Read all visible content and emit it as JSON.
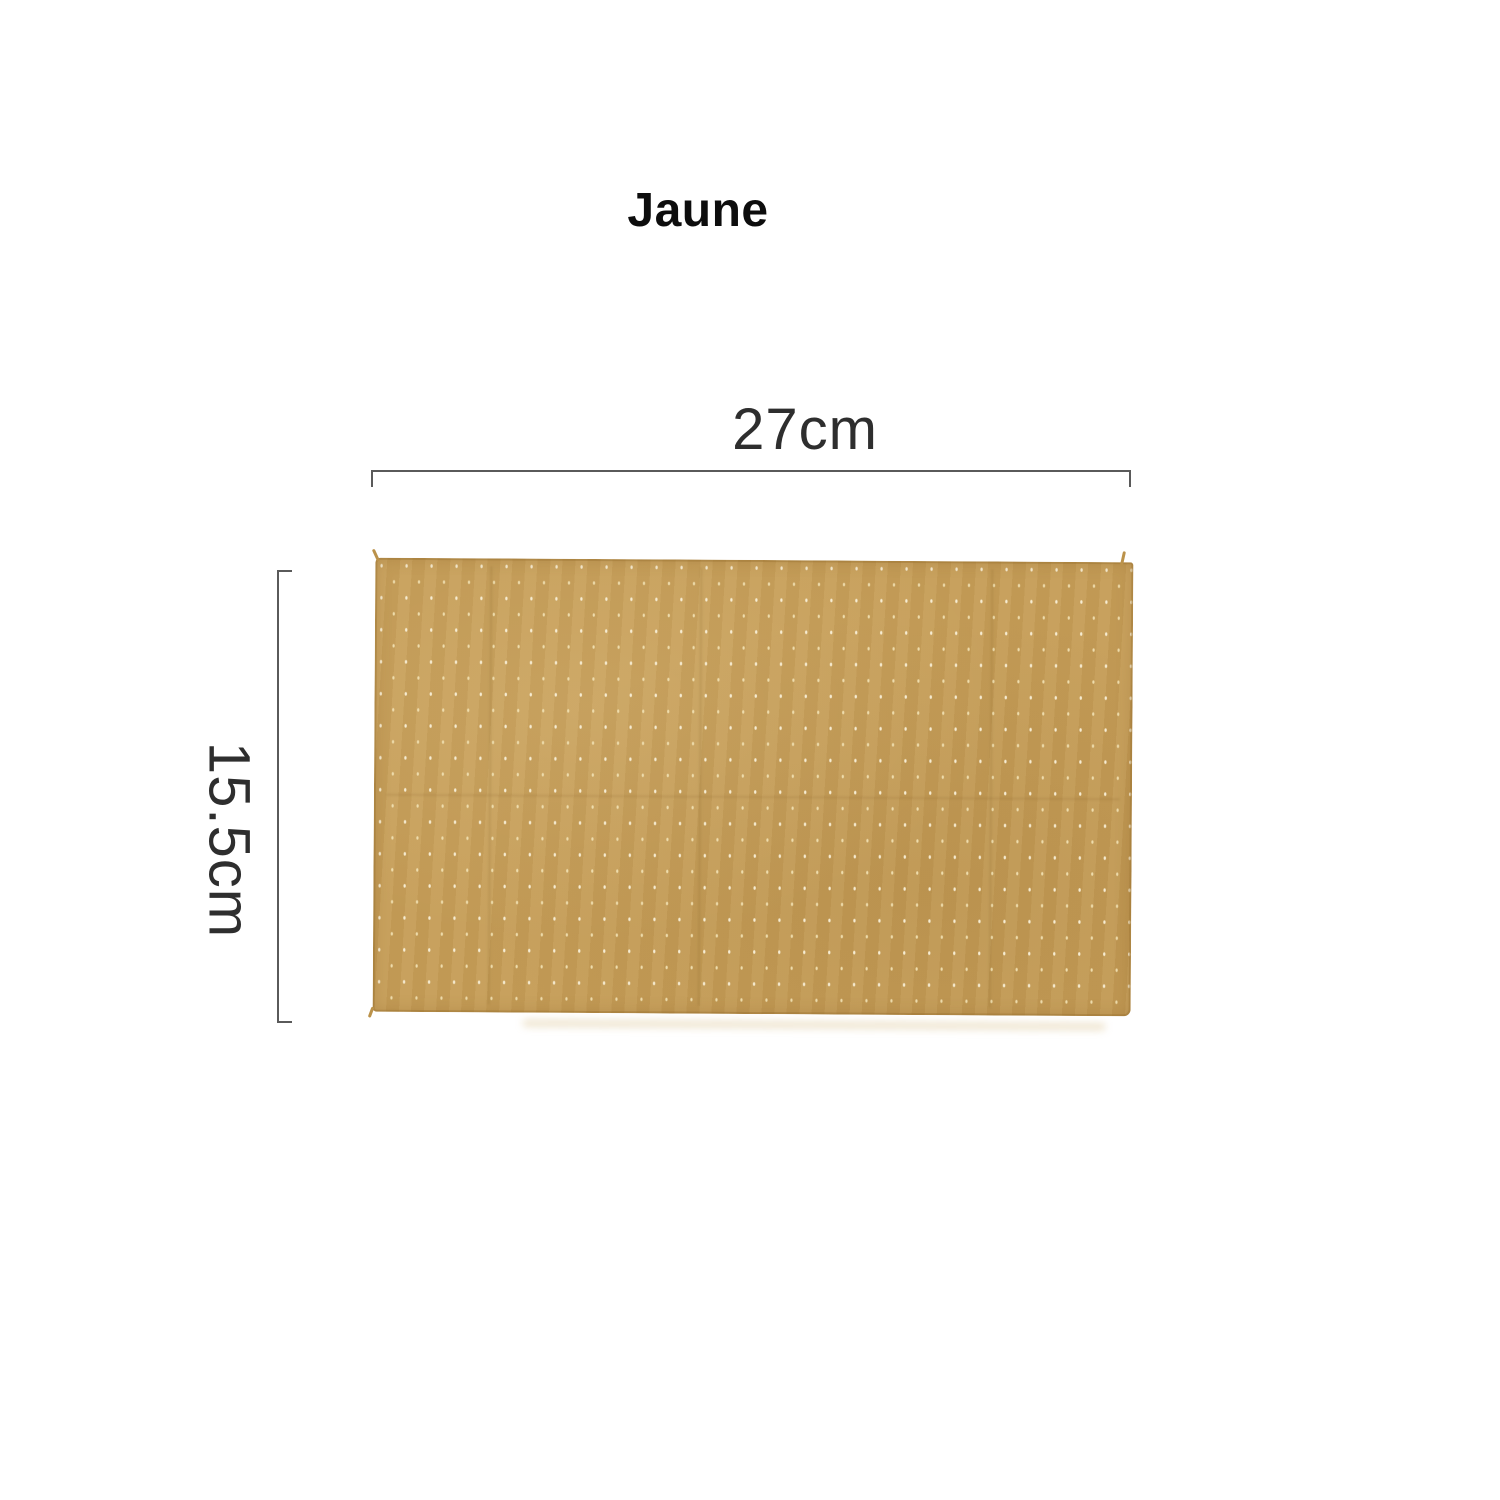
{
  "title": "Jaune",
  "dimension_annotations": {
    "width_label": "27cm",
    "height_label": "15.5cm"
  },
  "product_image": {
    "semantic_name": "mustard-polka-dot-cloth"
  },
  "colors": {
    "background": "#ffffff",
    "title-text": "#0d0d0d",
    "dim-text": "#2e2e2e",
    "dim-line": "#5a5a5a",
    "fabric-base": "#c59d58",
    "fabric-dot": "#f6ecd2",
    "fabric-dot-soft": "#eedcac",
    "fabric-fray": "#bb924a"
  }
}
